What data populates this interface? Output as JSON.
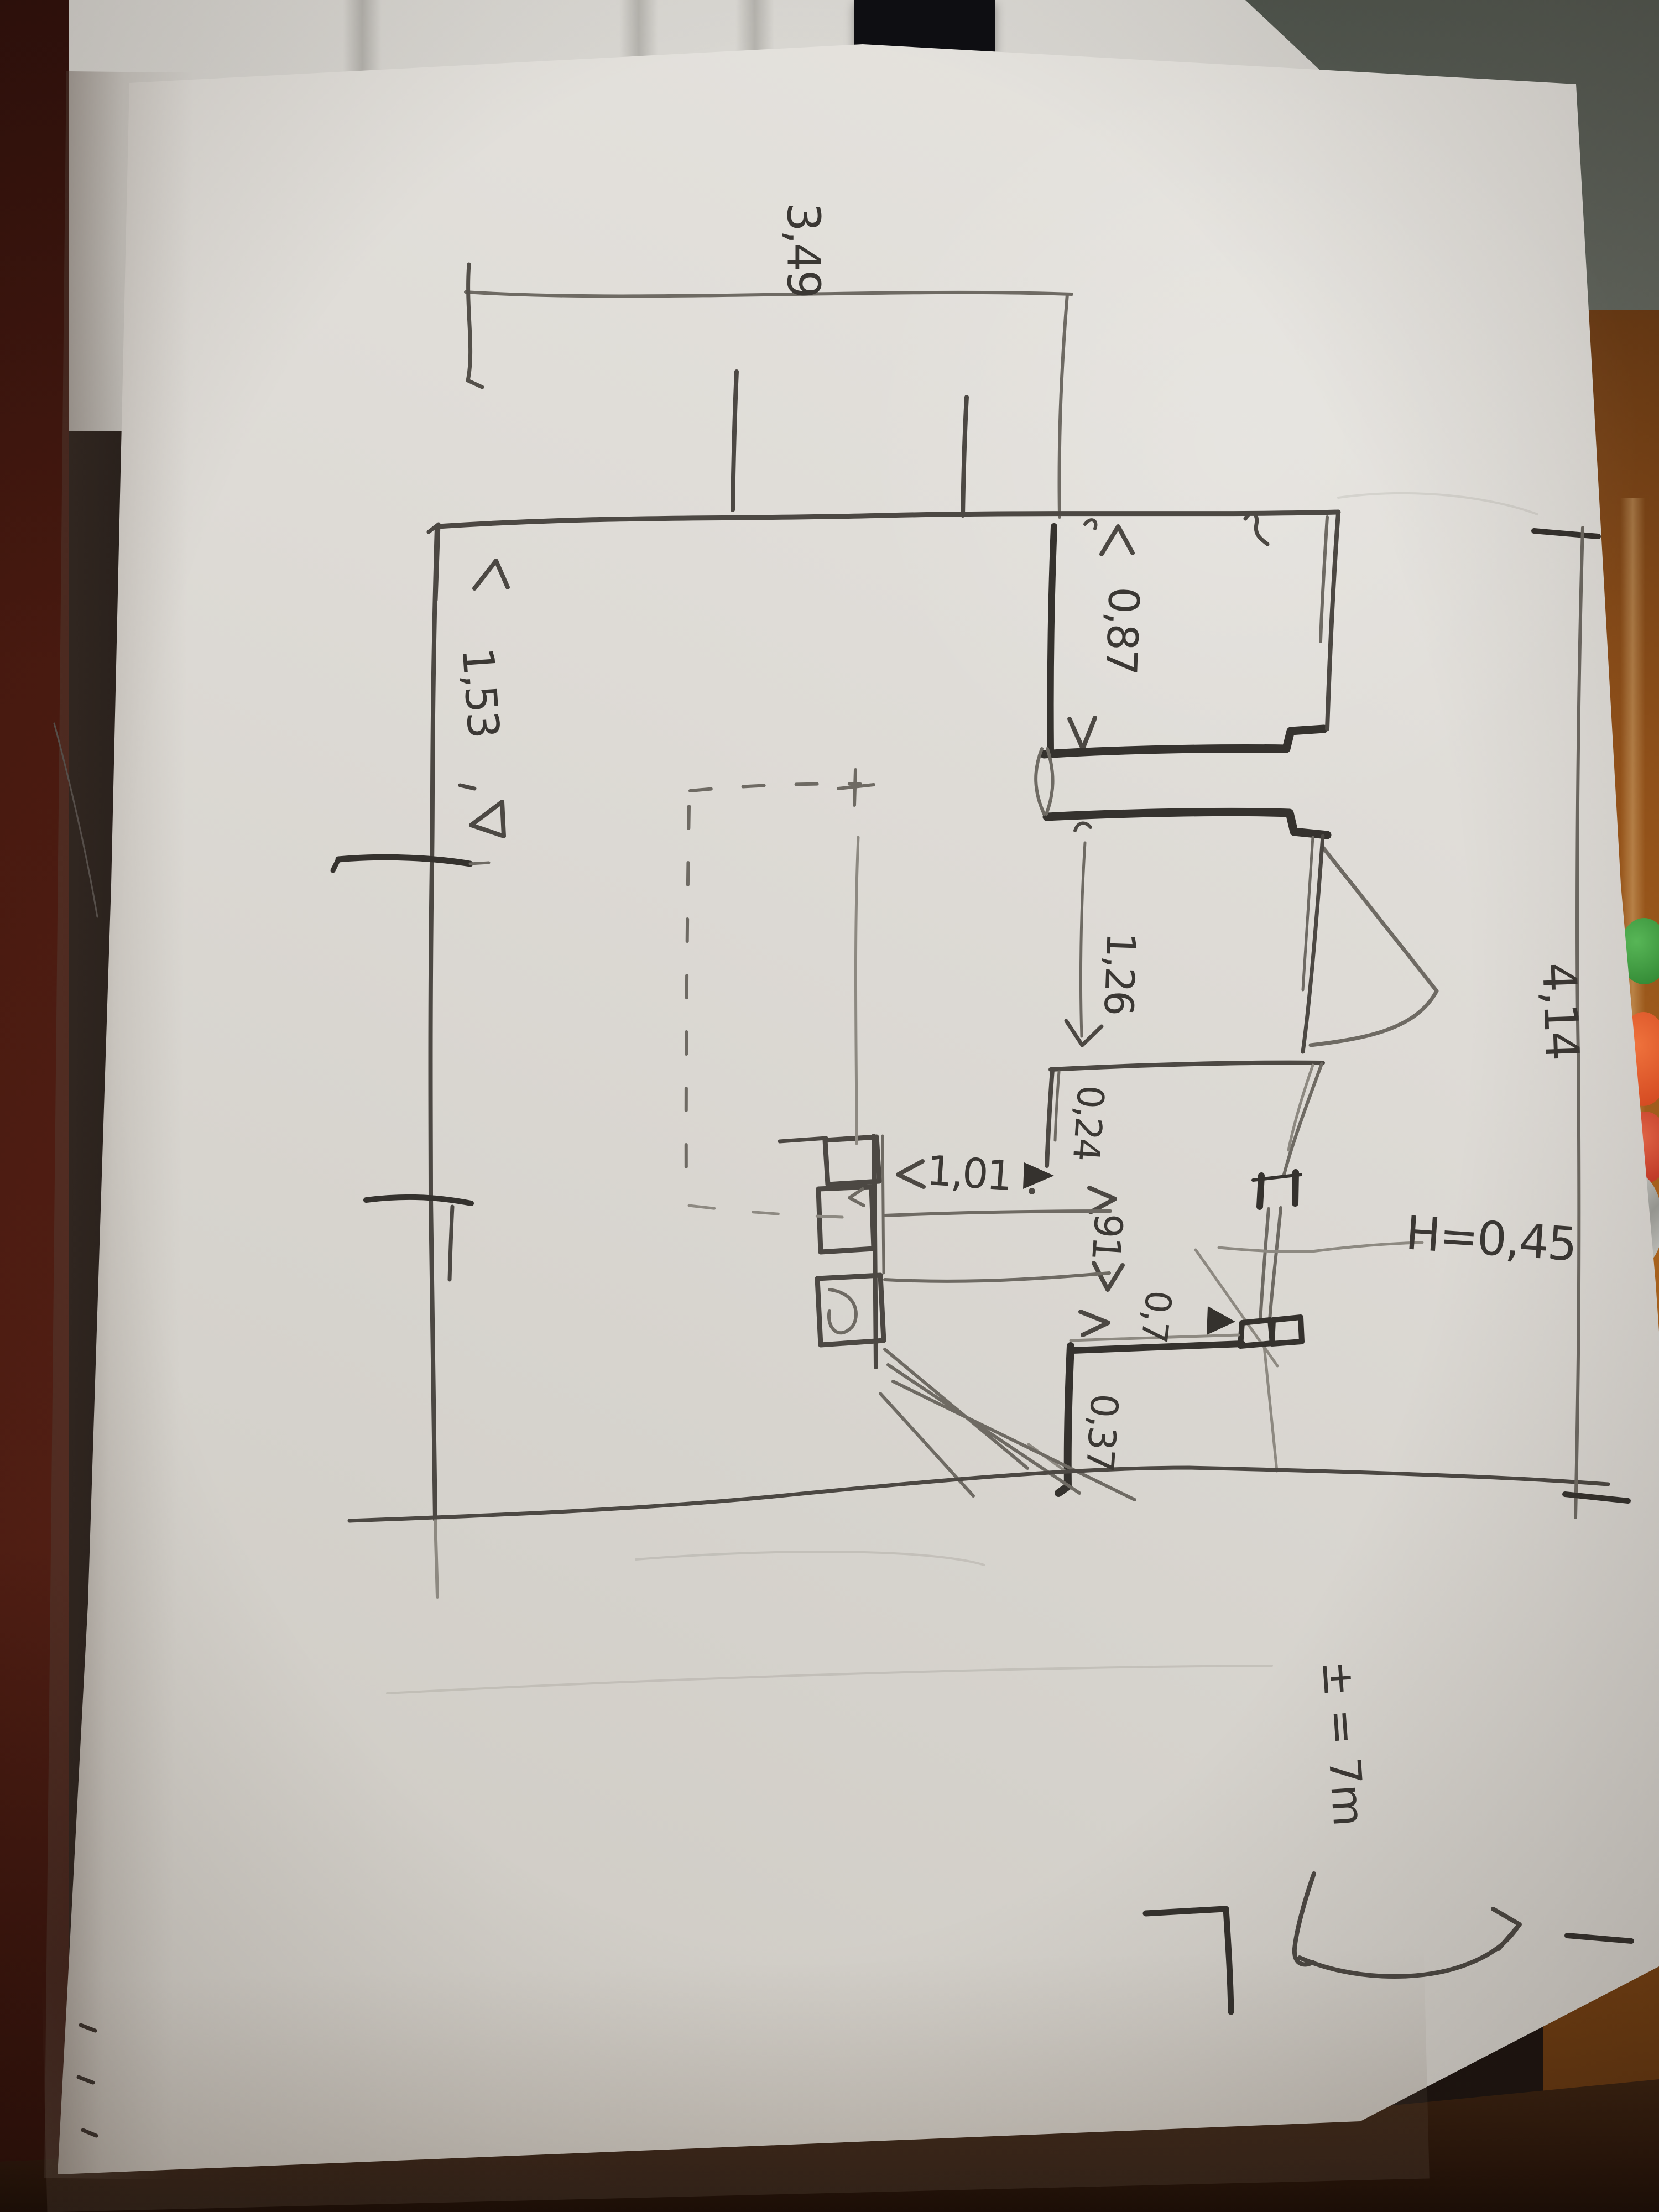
{
  "sketch": {
    "labels": [
      {
        "name": "top-width",
        "text": "3,49"
      },
      {
        "name": "right-height",
        "text": "4,14"
      },
      {
        "name": "opening-top-right",
        "text": "0,87"
      },
      {
        "name": "left-width",
        "text": "1,53"
      },
      {
        "name": "opening-right",
        "text": "1,26"
      },
      {
        "name": "pier-width",
        "text": "0,24"
      },
      {
        "name": "opening-middle",
        "text": "1,01"
      },
      {
        "name": "window-width",
        "text": "91"
      },
      {
        "name": "segment-width",
        "text": "0,7"
      },
      {
        "name": "sill-height-note",
        "text": "H=0,45"
      },
      {
        "name": "segment-bottom",
        "text": "0,37"
      },
      {
        "name": "floor-level-note",
        "text": "± = 7m"
      }
    ],
    "colors": {
      "paper": "#dbd8d2",
      "pencil": "#6e6a63",
      "pencil_dark": "#4c4843",
      "ink_bold": "#35322e",
      "notebook_cover": "#4a1a10",
      "table_wood": "#a05a1c",
      "wall_background": "#d5d3ce"
    }
  }
}
